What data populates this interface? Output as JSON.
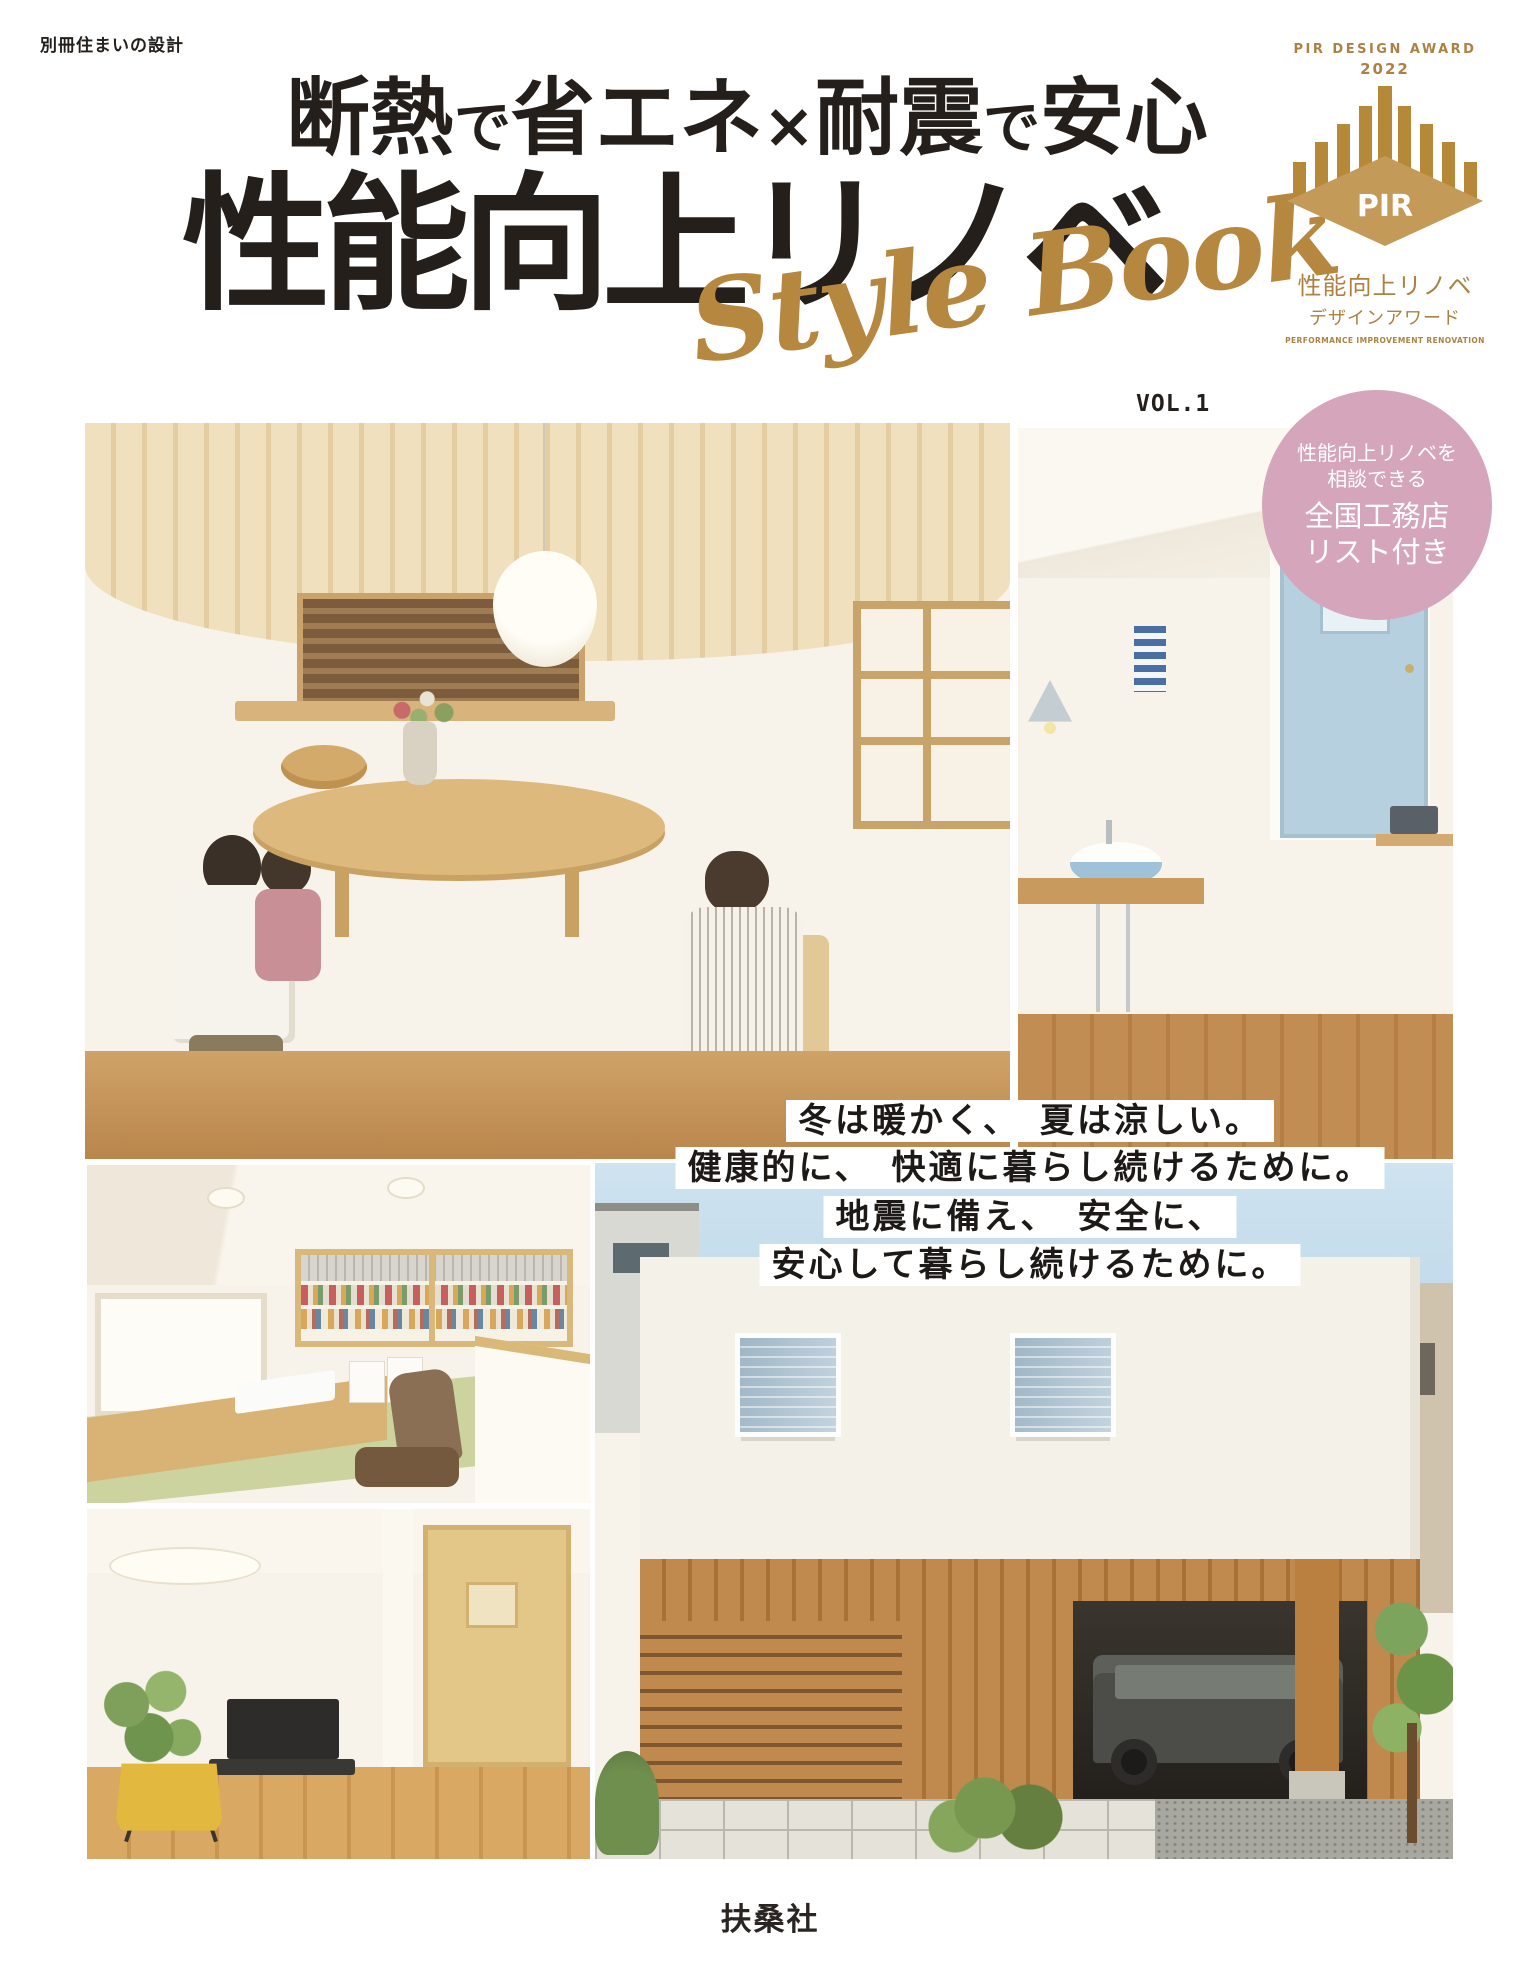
{
  "imprint": "別冊住まいの設計",
  "title": {
    "line1": [
      "断熱",
      "で",
      "省エネ",
      "×",
      "耐震",
      "で",
      "安心"
    ],
    "line2": "性能向上リノベ",
    "script": "Style Book",
    "vol": "VOL.1"
  },
  "award": {
    "heading": "PIR DESIGN AWARD",
    "year": "2022",
    "monogram": "PIR",
    "jp1": "性能向上リノベ",
    "jp2": "デザインアワード",
    "en": "PERFORMANCE IMPROVEMENT RENOVATION"
  },
  "circle_badge": {
    "l1": "性能向上リノベを",
    "l2": "相談できる",
    "l3": "全国工務店",
    "l4": "リスト付き"
  },
  "copy": {
    "l1": "冬は暖かく、　夏は涼しい。",
    "l2": "健康的に、　快適に暮らし続けるために。",
    "l3": "地震に備え、　安全に、",
    "l4": "安心して暮らし続けるために。"
  },
  "publisher": "扶桑社",
  "colors": {
    "paper": "#ffffff",
    "ink": "#241f1b",
    "gold": "#b6873e",
    "gold_light": "#c49a58",
    "gold_dark": "#ad8142",
    "pink": "#d5a6bb",
    "wall_cream": "#f8f3ea",
    "wood_ceiling": "#ecd7ae",
    "wood_floor": "#c6965c",
    "sky": "#bfd9ea",
    "door_blue": "#b7d0df",
    "tatami": "#ccd39e",
    "slat_wood": "#bb8449",
    "jeep": "#4c4d49",
    "chair_yellow": "#e2b83e"
  }
}
